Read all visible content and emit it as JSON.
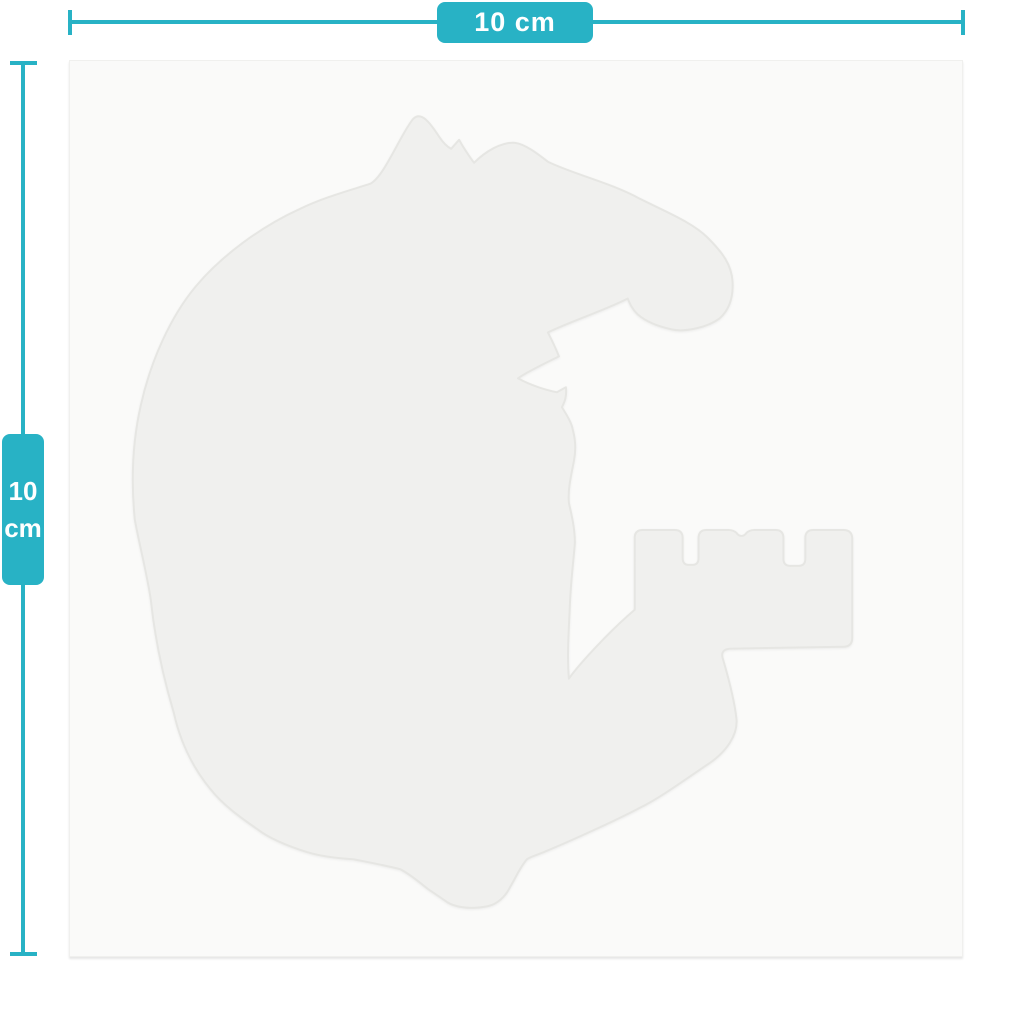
{
  "colors": {
    "accent": "#28b2c5",
    "page_background": "#ffffff",
    "card_background": "#fafaf9",
    "sticker_fill": "#f0f0ee",
    "sticker_edge": "#e6e6e3",
    "dimension_label_text": "#ffffff"
  },
  "dimensions": {
    "horizontal": {
      "label": "10 cm"
    },
    "vertical": {
      "value": "10",
      "unit": "cm"
    }
  }
}
